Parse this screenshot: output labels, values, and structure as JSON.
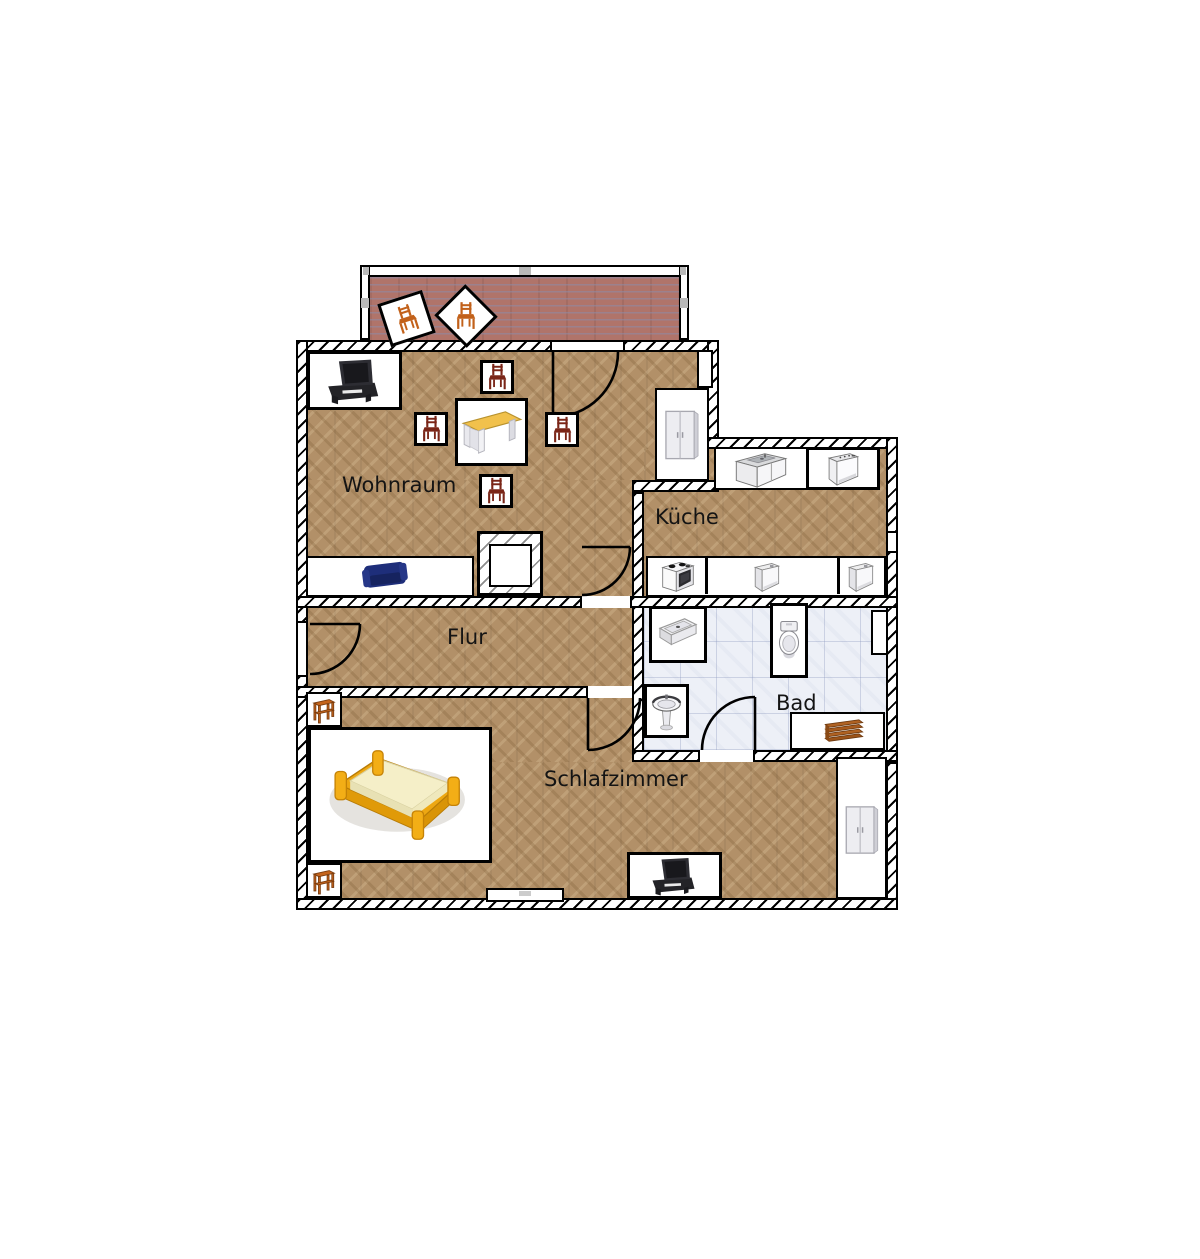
{
  "app": {
    "view": "apartment-floor-plan"
  },
  "rooms": {
    "wohnraum": {
      "label": "Wohnraum",
      "floor": "parquet",
      "furniture": [
        "tv-sideboard",
        "chair",
        "chair",
        "chair",
        "chair",
        "desk",
        "sofa",
        "wardrobe"
      ]
    },
    "kueche": {
      "label": "Küche",
      "floor": "parquet",
      "furniture": [
        "sink-cabinet",
        "dishwasher",
        "stove",
        "appliance",
        "appliance"
      ]
    },
    "flur": {
      "label": "Flur",
      "floor": "parquet",
      "furniture": []
    },
    "bad": {
      "label": "Bad",
      "floor": "tile",
      "furniture": [
        "shower",
        "toilet",
        "wash-basin",
        "radiator"
      ]
    },
    "schlafzimmer": {
      "label": "Schlafzimmer",
      "floor": "parquet",
      "furniture": [
        "nightstand",
        "bed",
        "nightstand",
        "tv-sideboard",
        "wardrobe"
      ]
    },
    "balkon": {
      "floor": "brick",
      "furniture": [
        "chair",
        "chair"
      ]
    }
  },
  "doors": [
    "balcony-door",
    "living-room-door",
    "entry-door",
    "bedroom-door",
    "bathroom-door"
  ],
  "windows": [
    "kitchen-window",
    "bedroom-window"
  ],
  "colors": {
    "background": "#ffffff",
    "parquet": "#b29068",
    "brick": "#b0746a",
    "tile": "#edf0f7",
    "wall_line": "#000000",
    "chair_wood": "#7a2517",
    "balcony_chair_wood": "#c2611a",
    "desk_top": "#f1c14c",
    "sofa": "#1e2e7a",
    "bed_frame": "#eda712",
    "bed_mattress": "#f5efc8",
    "radiator": "#b06222",
    "tv_unit": "#28282c"
  }
}
